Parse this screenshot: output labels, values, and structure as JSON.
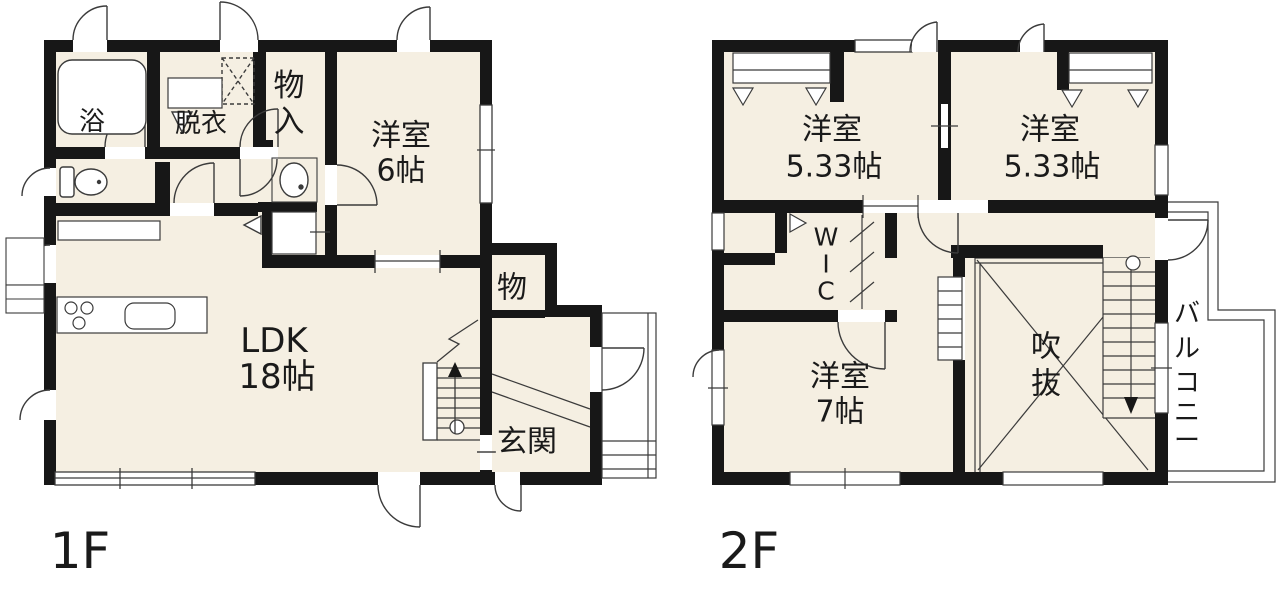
{
  "colors": {
    "room_fill": "#f5efe2",
    "wall": "#171717",
    "line": "#3b3b3b"
  },
  "f1": {
    "floor_label": "1F",
    "bath": "浴",
    "dressing": "脱衣",
    "storage_v": [
      "物",
      "入"
    ],
    "west6": [
      "洋室",
      "6帖"
    ],
    "ldk": [
      "LDK",
      "18帖"
    ],
    "closet": "物",
    "entrance": "玄関"
  },
  "f2": {
    "floor_label": "2F",
    "west533_left": [
      "洋室",
      "5.33帖"
    ],
    "west533_right": [
      "洋室",
      "5.33帖"
    ],
    "wic_v": [
      "W",
      "I",
      "C"
    ],
    "west7": [
      "洋室",
      "7帖"
    ],
    "void_v": [
      "吹",
      "抜"
    ],
    "balcony_v": [
      "バ",
      "ル",
      "コ",
      "ニ",
      "ー"
    ]
  }
}
